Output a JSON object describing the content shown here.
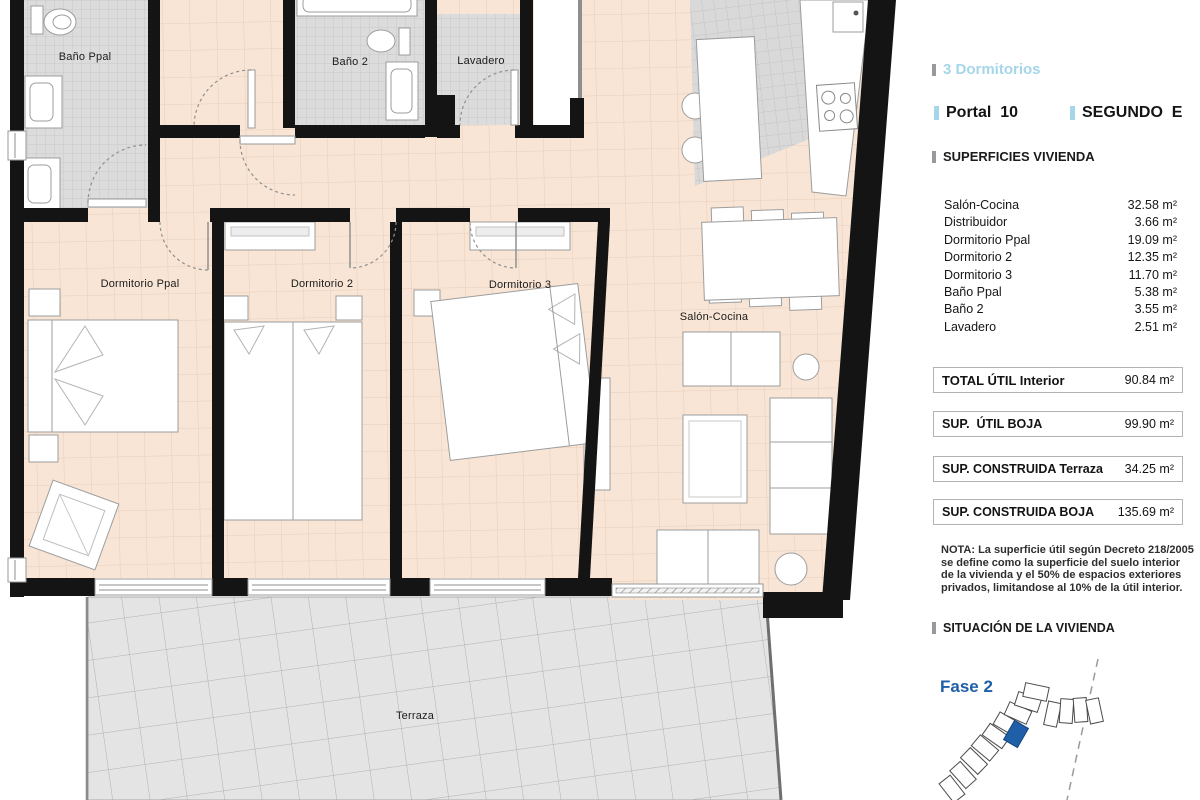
{
  "panel": {
    "type_label": "3 Dormitorios",
    "portal_label": "Portal  10",
    "floor_label": "SEGUNDO  E",
    "surfaces_title": "SUPERFICIES VIVIENDA",
    "rooms": [
      {
        "name": "Salón-Cocina",
        "area": "32.58 m²"
      },
      {
        "name": "Distribuidor",
        "area": "3.66 m²"
      },
      {
        "name": "Dormitorio Ppal",
        "area": "19.09 m²"
      },
      {
        "name": "Dormitorio 2",
        "area": "12.35 m²"
      },
      {
        "name": "Dormitorio 3",
        "area": "11.70 m²"
      },
      {
        "name": "Baño Ppal",
        "area": "5.38 m²"
      },
      {
        "name": "Baño 2",
        "area": "3.55 m²"
      },
      {
        "name": "Lavadero",
        "area": "2.51 m²"
      }
    ],
    "totals": [
      {
        "label": "TOTAL ÚTIL Interior",
        "value": "90.84 m²"
      },
      {
        "label": "SUP.  ÚTIL BOJA",
        "value": "99.90 m²"
      },
      {
        "label": "SUP. CONSTRUIDA Terraza",
        "value": "34.25 m²"
      },
      {
        "label": "SUP. CONSTRUIDA BOJA",
        "value": "135.69 m²"
      }
    ],
    "note": "NOTA: La superficie útil según Decreto 218/2005 se define como la superficie del suelo interior de la vivienda y el 50% de espacios exteriores privados, limitandose al 10% de la útil interior.",
    "situation_title": "SITUACIÓN DE LA VIVIENDA",
    "phase_label": "Fase 2"
  },
  "plan": {
    "labels": {
      "bano_ppal": "Baño Ppal",
      "bano_2": "Baño 2",
      "lavadero": "Lavadero",
      "dorm_ppal": "Dormitorio Ppal",
      "dorm_2": "Dormitorio 2",
      "dorm_3": "Dormitorio 3",
      "salon": "Salón-Cocina",
      "terraza": "Terraza"
    }
  },
  "colors": {
    "accent_blue": "#a5d6e9",
    "phase_blue": "#1e5fa8",
    "wall_black": "#141414",
    "floor_peach": "#f8e5d5",
    "tile_gray": "#dcdcdc",
    "terrace_gray": "#e4e4e4"
  }
}
